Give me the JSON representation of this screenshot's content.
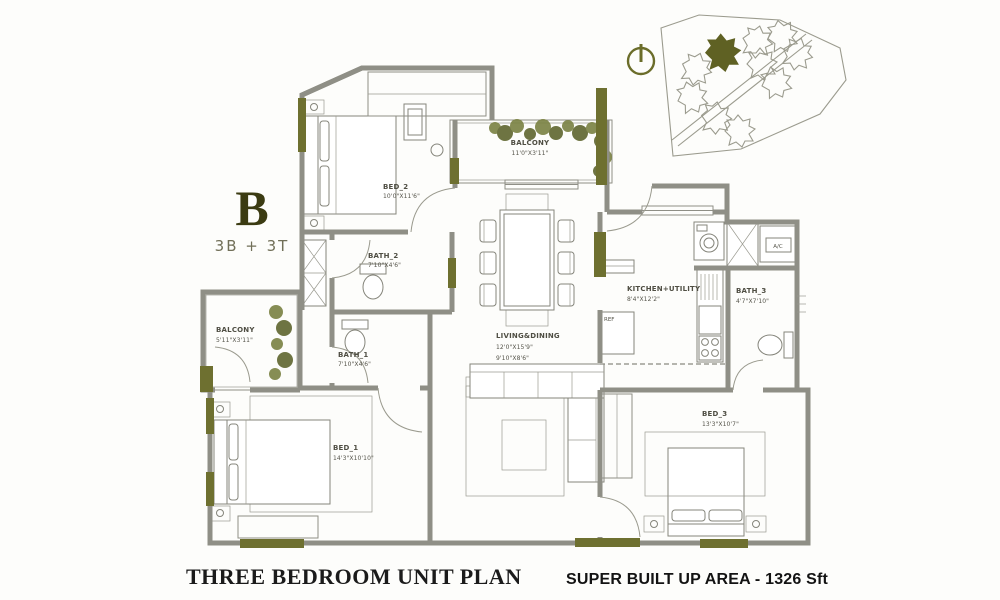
{
  "unit": {
    "letter": "B",
    "configuration": "3B + 3T"
  },
  "plan": {
    "rooms": {
      "bed2": {
        "name": "BED_2",
        "dim": "10'0\"X11'6\""
      },
      "balcony_top": {
        "name": "BALCONY",
        "dim": "11'0\"X3'11\""
      },
      "bath2": {
        "name": "BATH_2",
        "dim": "7'10\"X4'6\""
      },
      "bath1": {
        "name": "BATH_1",
        "dim": "7'10\"X4'6\""
      },
      "balcony_left": {
        "name": "BALCONY",
        "dim": "5'11\"X3'11\""
      },
      "bed1": {
        "name": "BED_1",
        "dim": "14'3\"X10'10\""
      },
      "living": {
        "name": "LIVING&DINING",
        "dim1": "12'0\"X15'9\"",
        "dim2": "9'10\"X8'6\""
      },
      "kitchen": {
        "name": "KITCHEN+UTILITY",
        "dim": "8'4\"X12'2\""
      },
      "bath3": {
        "name": "BATH_3",
        "dim": "4'7\"X7'10\""
      },
      "bed3": {
        "name": "BED_3",
        "dim": "13'3\"X10'7\""
      }
    },
    "fixtures": {
      "ac": "A/C",
      "ref": "REF"
    }
  },
  "footer": {
    "title": "THREE BEDROOM UNIT PLAN",
    "area_label": "SUPER BUILT UP AREA -",
    "area_value": "1326 Sft"
  },
  "colors": {
    "accent_olive": "#6e7030",
    "wall_gray": "#8f8f86",
    "plant_green": "#7a8142",
    "text_dark": "#1b1b1b"
  }
}
